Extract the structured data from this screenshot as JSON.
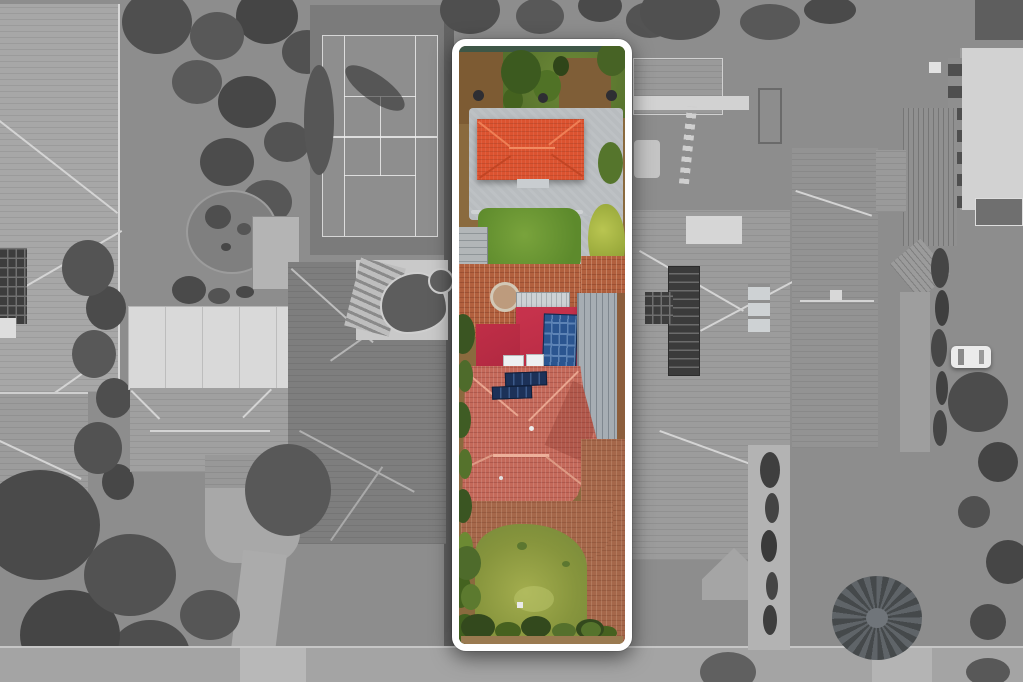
{
  "scene": {
    "kind": "aerial-drone-photograph",
    "purpose": "real-estate listing image: long narrow residential lot highlighted in colour, all surrounding properties desaturated to grayscale",
    "canvas": {
      "width": 1023,
      "height": 682
    },
    "highlight_frame": {
      "shape": "rounded-rectangle outline",
      "color": "#ffffff",
      "approx_region": {
        "x": 452,
        "y": 39,
        "width": 180,
        "height": 612
      }
    }
  },
  "palette": {
    "frame_white": "#ffffff",
    "garage_roof_orange": "#dc5330",
    "flat_roof_crimson": "#c02e47",
    "main_roof_terracotta": "#c4695a",
    "solar_panel_blue": "#2b5590",
    "solar_panel_dark_blue": "#1c3158",
    "metal_roof_gray": "#a6adb3",
    "paving_terracotta": "#b2603e",
    "driveway_concrete": "#b8bcbf",
    "lawn_green": "#6f9c35",
    "rear_lawn_olive": "#87953d",
    "bush_bright_green": "#9cab3c",
    "tree_dark_green": "#3c5a1f",
    "dirt_brown": "#7d5b33",
    "surroundings_gray": "#8d8d8d",
    "road_gray": "#a4a4a4",
    "tennis_court_gray": "#8e8e8e",
    "pool_gray": "#5d6468"
  },
  "highlighted_property_features": [
    "rear-garden-trees",
    "dirt-patches",
    "garbage-bins",
    "rear-driveway-concrete",
    "garage-orange-hip-roof",
    "middle-lawn",
    "garden-shed",
    "large-bright-bush",
    "terracotta-paved-courtyard",
    "circular-paver-feature",
    "atrium-ridged-roof",
    "flat-crimson-roof",
    "upper-solar-panel-array",
    "gray-metal-roof",
    "skylights",
    "main-terracotta-tiled-roof",
    "lower-solar-panel-array",
    "side-garden-strip",
    "rear-paving",
    "front-lawn",
    "front-hedge"
  ],
  "surroundings_features": [
    "left-house-roof-with-solar-panels",
    "tennis-court",
    "tree-clusters",
    "circular-garden-bed",
    "white-roofed-building",
    "mid-left-hip-roof",
    "mansion-dark-roof",
    "kidney-swimming-pool",
    "pool-deck-stairs",
    "front-lawns-and-trees",
    "street-road",
    "neighbor-backyard-pool",
    "stepping-stone-path",
    "right-neighbor-roof-with-solar-strip",
    "apartment-building",
    "corrugated-roof-house",
    "white-parked-car",
    "dark-hedge-row",
    "palm-tree",
    "driveways"
  ]
}
